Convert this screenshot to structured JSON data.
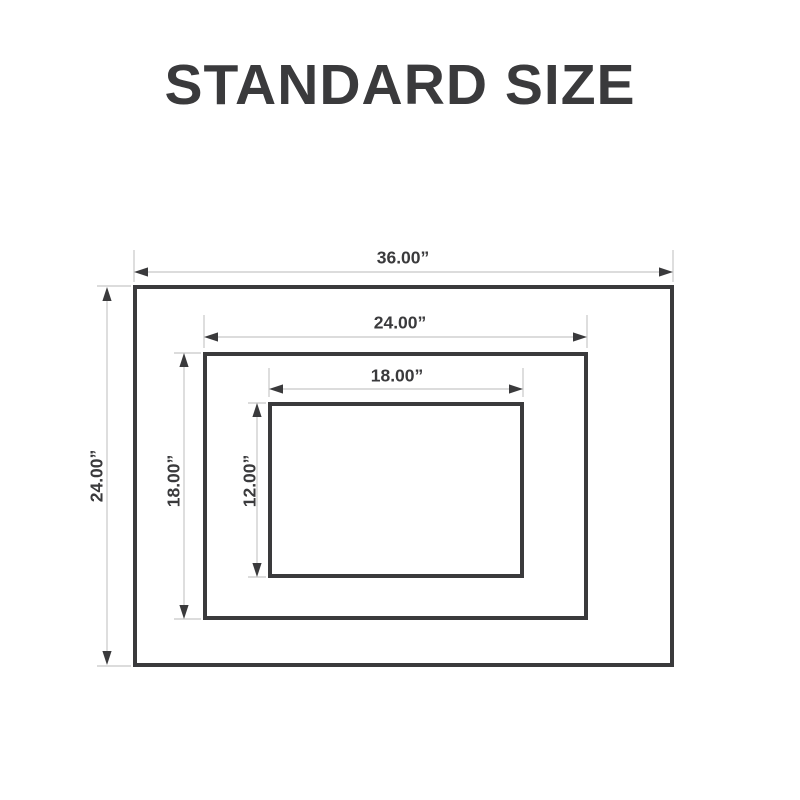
{
  "title": "STANDARD SIZE",
  "colors": {
    "ink": "#3a3a3c",
    "dim_line": "#c7c7c7",
    "background": "#ffffff"
  },
  "diagram": {
    "outer": {
      "width_label": "36.00”",
      "height_label": "24.00”"
    },
    "middle": {
      "width_label": "24.00”",
      "height_label": "18.00”"
    },
    "inner": {
      "width_label": "18.00”",
      "height_label": "12.00”"
    }
  }
}
